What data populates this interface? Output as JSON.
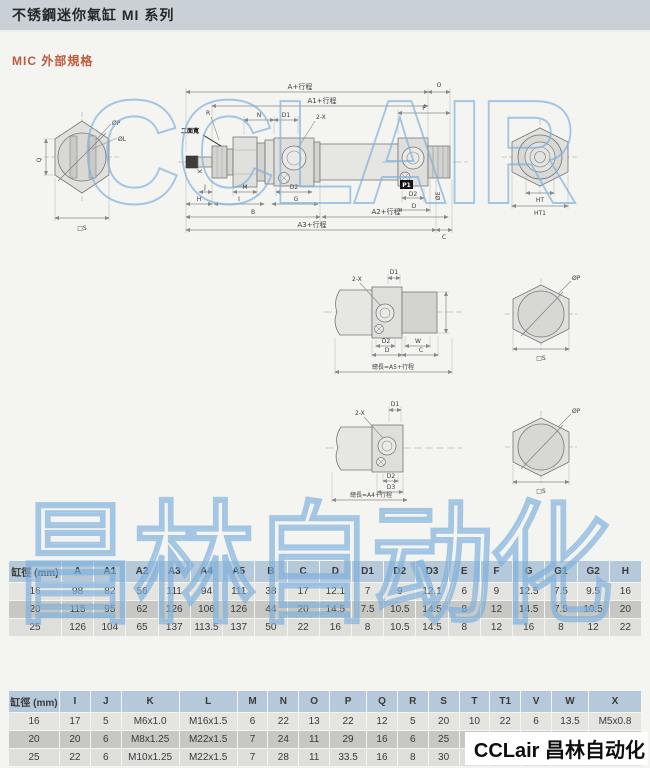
{
  "header": {
    "title": "不锈鋼迷你氣缸 MI 系列"
  },
  "section": {
    "label": "MIC 外部規格",
    "color": "#bd5a3c"
  },
  "watermarks": {
    "top": "CCLAIR",
    "bottom": "昌林自动化",
    "color": "#7eb0dc"
  },
  "logo": {
    "text": "CCLair 昌林自动化"
  },
  "drawing": {
    "labels": {
      "a_stroke": "A+行程",
      "a1_stroke": "A1+行程",
      "a2_stroke": "A2+行程",
      "a3_stroke": "A3+行程",
      "o": "O",
      "f": "F",
      "n": "N",
      "d1": "D1",
      "two_x": "2-X",
      "r": "R",
      "two_flats": "二面寬",
      "k": "K",
      "j": "J",
      "h": "H",
      "m": "M",
      "i": "I",
      "d2": "D2",
      "g": "G",
      "b": "B",
      "p1": "P1",
      "d": "D",
      "oe": "ØE",
      "c": "C",
      "q": "Q",
      "op": "ØP",
      "ol": "ØL",
      "sq_s": "□S",
      "ht": "HT",
      "ht1": "HT1",
      "w": "W",
      "d3": "D3",
      "total_a5": "總長=A5+行程",
      "total_a4": "總長=A4+行程"
    }
  },
  "table1": {
    "headers": [
      "缸徑 (mm)",
      "A",
      "A1",
      "A2",
      "A3",
      "A4",
      "A5",
      "B",
      "C",
      "D",
      "D1",
      "D2",
      "D3",
      "E",
      "F",
      "G",
      "G1",
      "G2",
      "H"
    ],
    "rows": [
      [
        "16",
        "98",
        "82",
        "56",
        "111",
        "94",
        "111",
        "38",
        "17",
        "12.1",
        "7",
        "9",
        "12.1",
        "6",
        "9",
        "12.5",
        "7.5",
        "9.5",
        "16"
      ],
      [
        "20",
        "115",
        "95",
        "62",
        "126",
        "106",
        "126",
        "44",
        "20",
        "14.5",
        "7.5",
        "10.5",
        "14.5",
        "8",
        "12",
        "14.5",
        "7.5",
        "10.5",
        "20"
      ],
      [
        "25",
        "126",
        "104",
        "65",
        "137",
        "113.5",
        "137",
        "50",
        "22",
        "16",
        "8",
        "10.5",
        "14.5",
        "8",
        "12",
        "16",
        "8",
        "12",
        "22"
      ]
    ]
  },
  "table2": {
    "headers": [
      "缸徑 (mm)",
      "I",
      "J",
      "K",
      "L",
      "M",
      "N",
      "O",
      "P",
      "Q",
      "R",
      "S",
      "T",
      "T1",
      "V",
      "W",
      "X"
    ],
    "rows": [
      [
        "16",
        "17",
        "5",
        "M6x1.0",
        "M16x1.5",
        "6",
        "22",
        "13",
        "22",
        "12",
        "5",
        "20",
        "10",
        "22",
        "6",
        "13.5",
        "M5x0.8"
      ],
      [
        "20",
        "20",
        "6",
        "M8x1.25",
        "M22x1.5",
        "7",
        "24",
        "11",
        "29",
        "16",
        "6",
        "25",
        "12",
        "",
        "",
        "",
        "1/8PT"
      ],
      [
        "25",
        "22",
        "6",
        "M10x1.25",
        "M22x1.5",
        "7",
        "28",
        "11",
        "33.5",
        "16",
        "8",
        "30",
        "17",
        "29",
        "10",
        "18.5",
        "1/8PT"
      ]
    ]
  }
}
